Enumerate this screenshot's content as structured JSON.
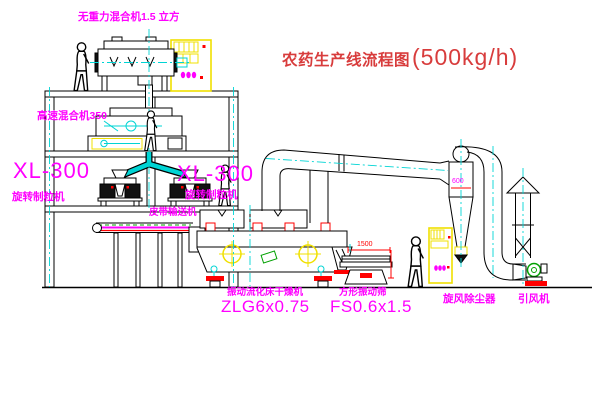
{
  "title": {
    "text": "农药生产线流程图",
    "capacity": "(500kg/h)"
  },
  "labels": {
    "gravity_mixer": "无重力混合机1.5 立方",
    "high_speed_mixer": "高速混合机350",
    "xl300_left": "XL-300",
    "granulator_left": "旋转制粒机",
    "xl300_mid": "XL-300",
    "granulator_mid": "旋转制粒机",
    "belt_conveyor": "皮带输送机",
    "dryer_name": "振动流化床干燥机",
    "dryer_model": "ZLG6x0.75",
    "screen_name": "方形振动筛",
    "screen_model": "FS0.6x1.5",
    "cyclone": "旋风除尘器",
    "fan": "引风机"
  },
  "dimensions": {
    "cyclone": "600",
    "screen": "1500"
  },
  "colors": {
    "label": "#ff00ff",
    "title": "#d83c3c",
    "dimension": "#ff0000",
    "outline": "#000000",
    "centerline": "#00d4d4",
    "cabinet": "#f0e000",
    "accent_green": "#00a000"
  }
}
